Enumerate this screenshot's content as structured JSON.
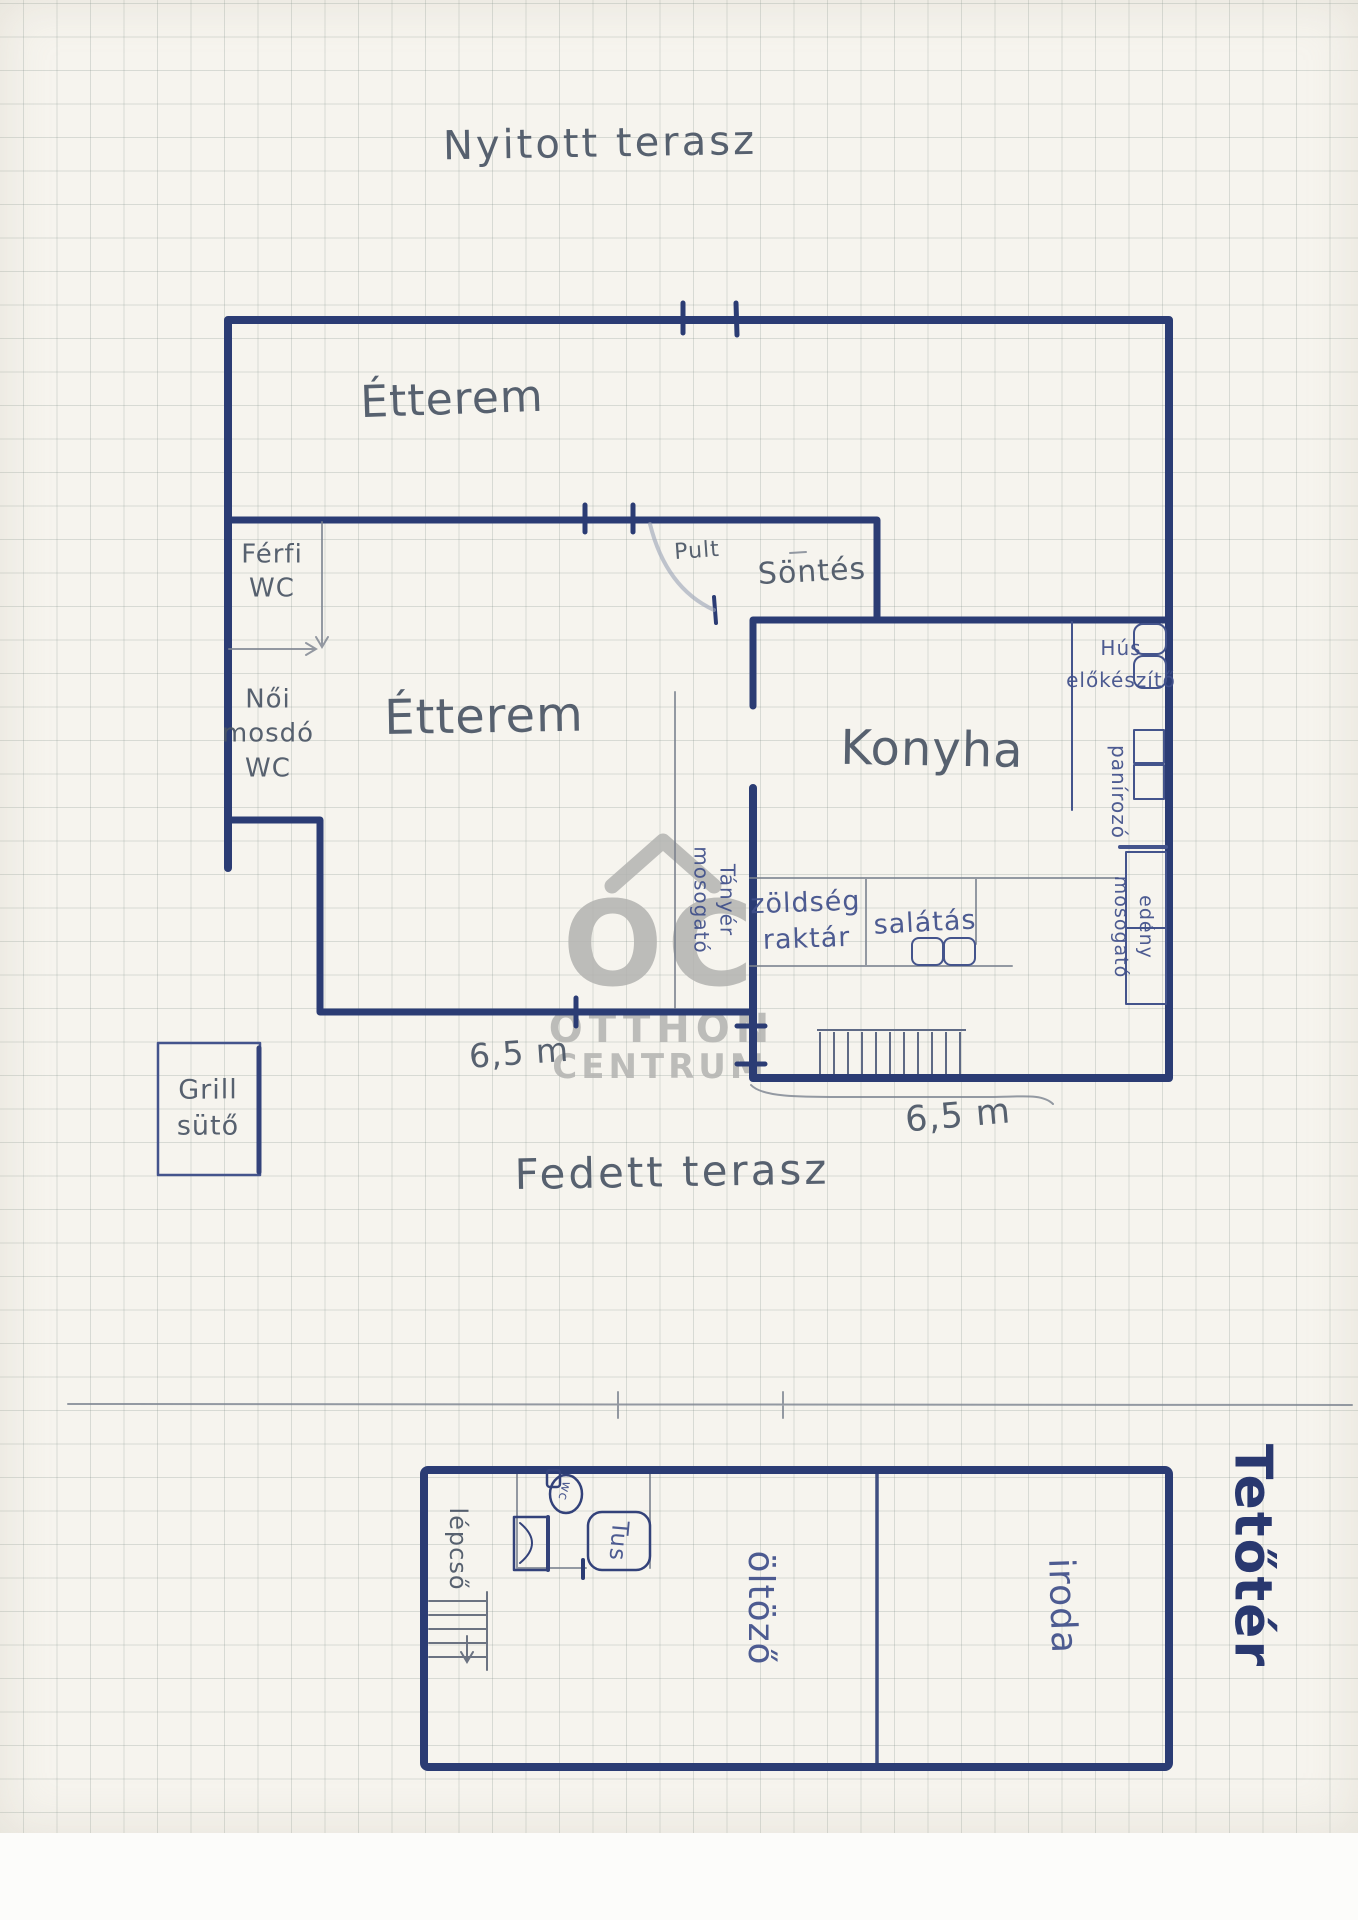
{
  "colors": {
    "wall_ink": "#2b3c74",
    "blue_pen": "#3f4f8a",
    "pencil": "#4a5565",
    "watermark_gray": "#b3b3b0",
    "paper": "#f6f4ee"
  },
  "labels": {
    "nyitott_terasz": "Nyitott terasz",
    "etterem_felso": "Étterem",
    "ferfi_wc": "Férfi\nWC",
    "noi_mosdo": "Női\nmosdó\nWC",
    "pult": "Pult",
    "sontes": "Söntés",
    "etterem_also": "Étterem",
    "konyha": "Konyha",
    "hus_elokeszito": "Hús\nelőkészítő",
    "panirozo": "panírozó",
    "edeny_mosogato": "edény\nmosogató",
    "tanyer_mosogato": "Tányér\nmosogató",
    "zoldseg_raktar": "zöldség\nraktár",
    "salatas": "salátás",
    "dim_etterem": "6,5 m",
    "dim_konyha": "6,5 m",
    "grill_suto": "Grill\nsütő",
    "fedett_terasz": "Fedett terasz",
    "lepcso": "lépcső",
    "wc_kis": "wc",
    "tus": "Tus",
    "oltozo": "öltöző",
    "iroda": "iroda",
    "tetoter": "Tetőtér"
  },
  "watermark": {
    "oc": "OC",
    "line1": "OTTHON",
    "line2": "CENTRUM"
  }
}
